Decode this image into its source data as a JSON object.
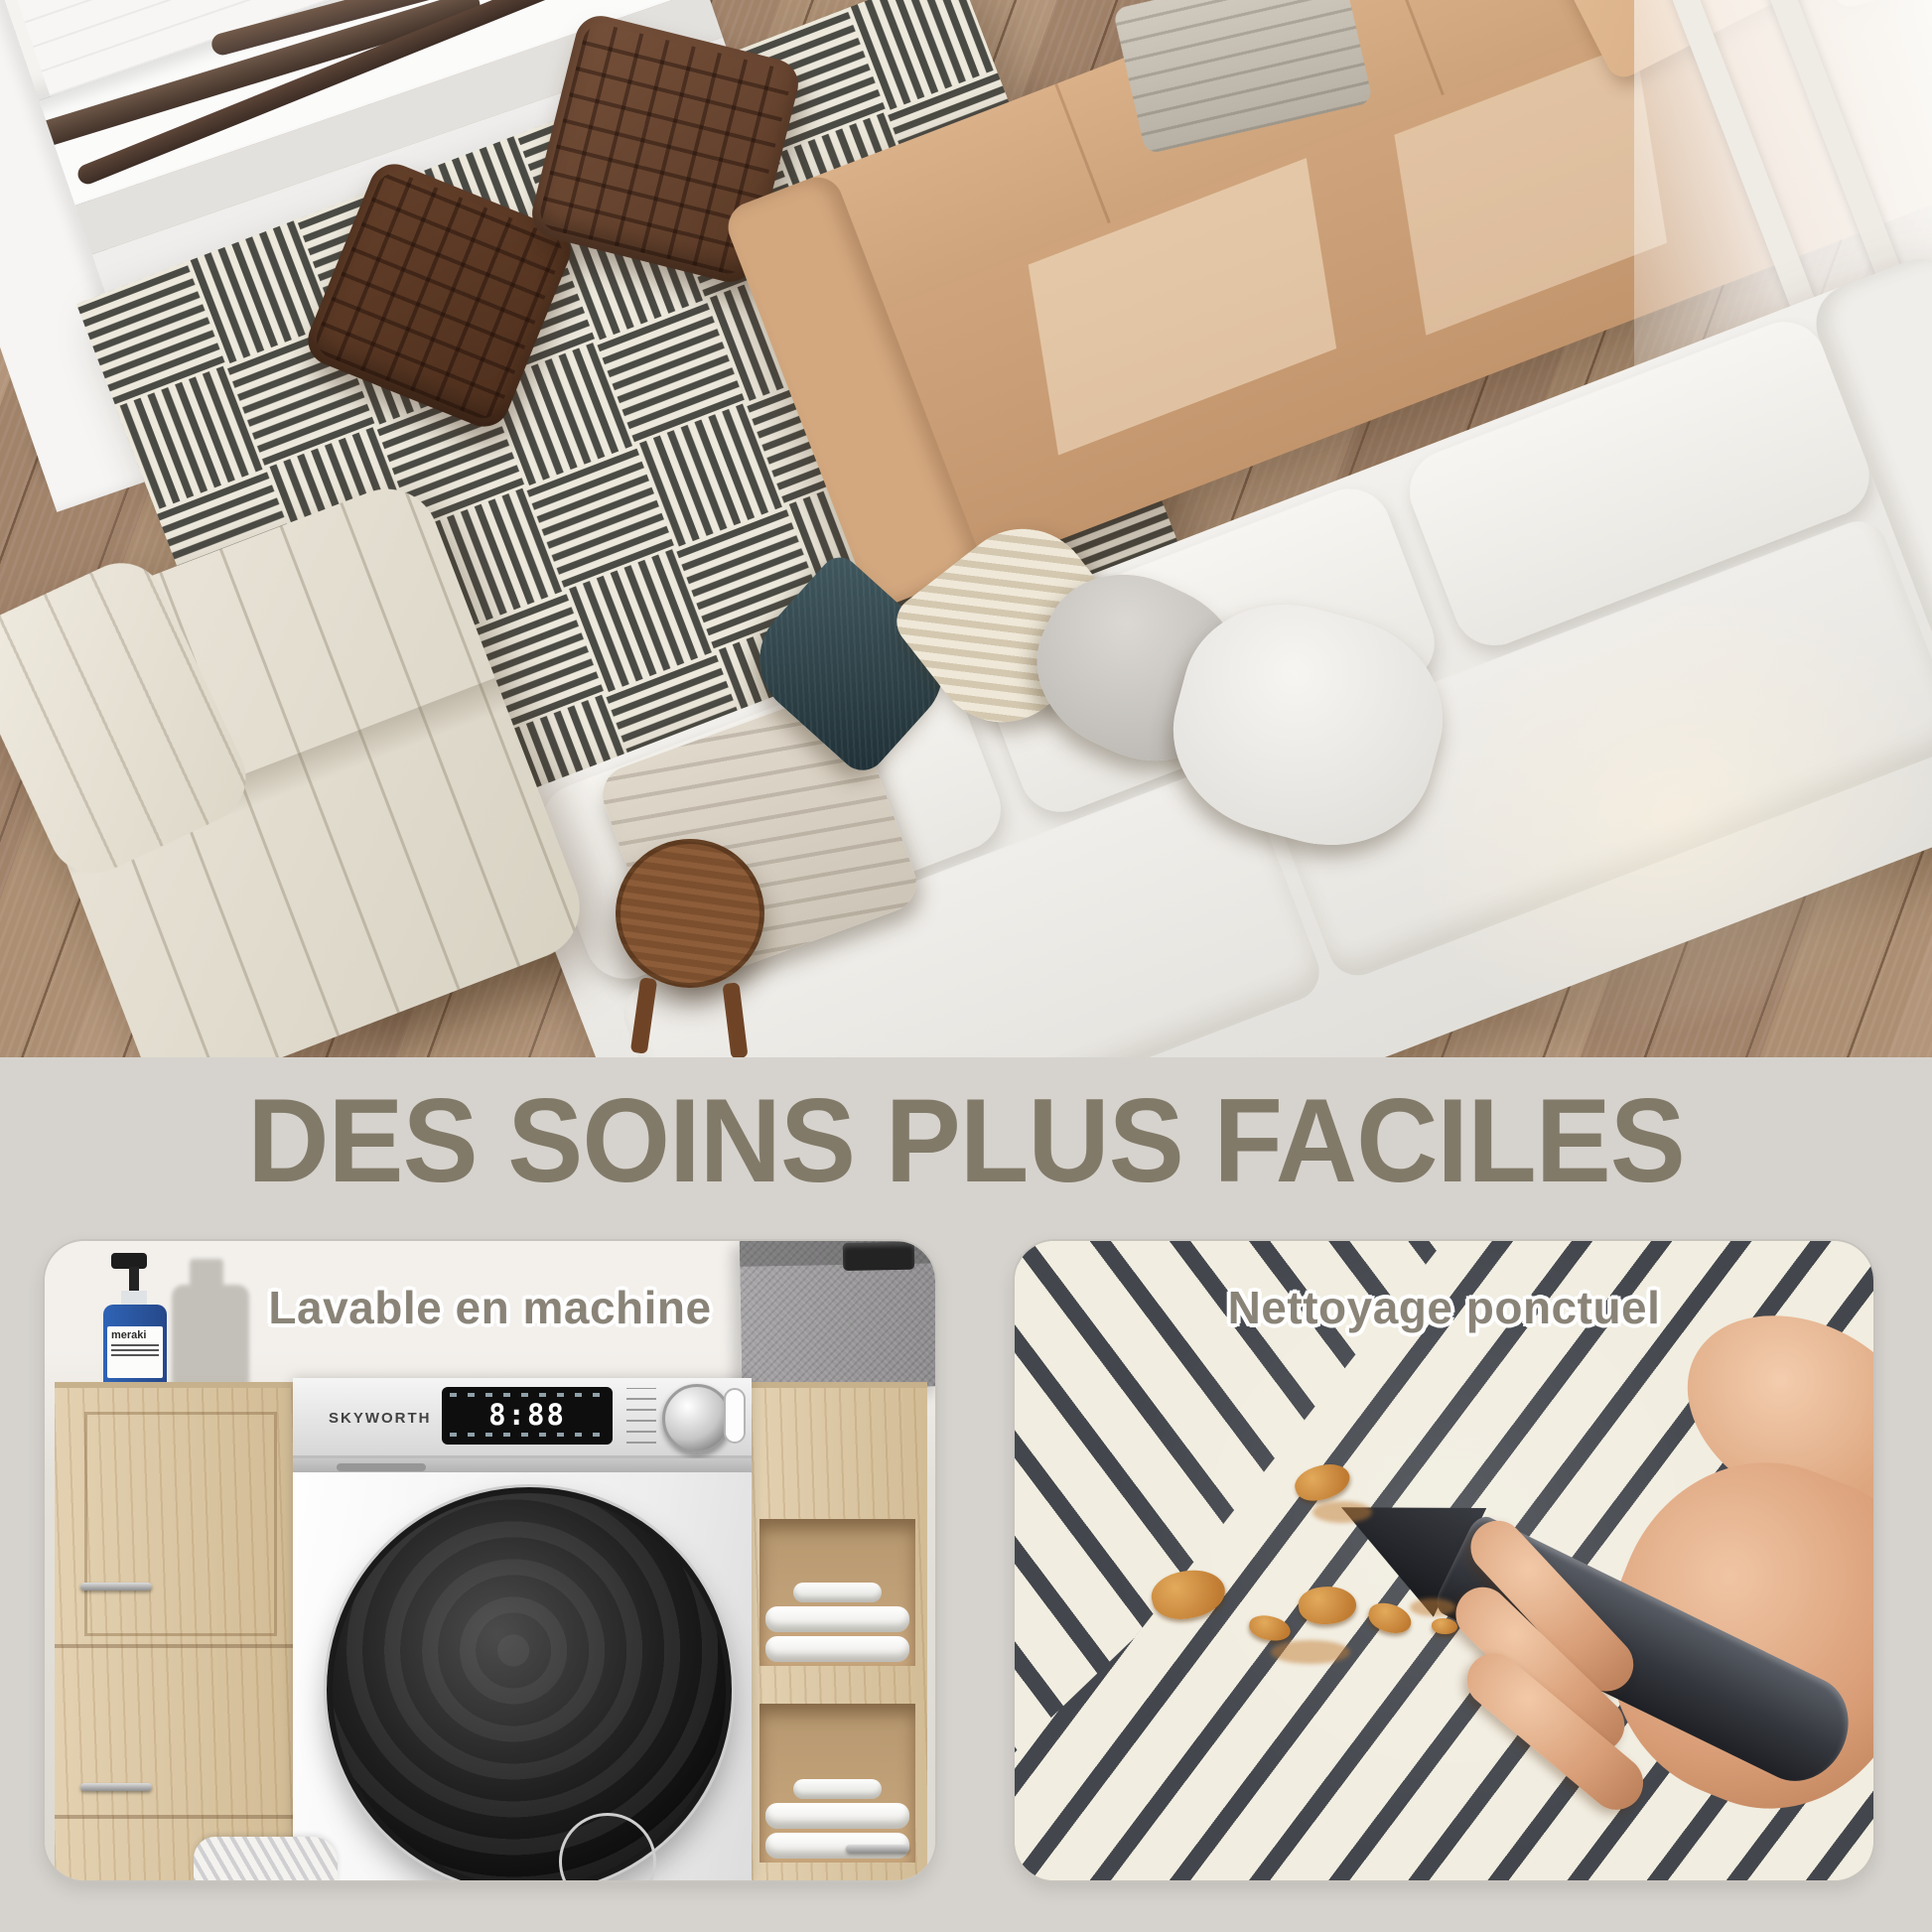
{
  "heading": {
    "text": "DES SOINS PLUS FACILES",
    "color": "#827a69"
  },
  "section": {
    "background": "#d6d3ce"
  },
  "left_panel": {
    "caption": "Lavable en machine",
    "machine_brand": "SKYWORTH",
    "machine_display_time": "8:88",
    "bottle_label": "meraki"
  },
  "right_panel": {
    "caption": "Nettoyage ponctuel"
  },
  "palette": {
    "caption_color": "#8a8478",
    "rug_dark": "#43474d",
    "rug_cream": "#f1ede0",
    "floor_wood": "#ab8e72",
    "sofa_tan": "#cba27b",
    "sofa_white": "#eceae6",
    "pouf_brown": "#5f3d29",
    "accent_blue_bottle": "#2f64b6",
    "teal_pillow": "#2f444b"
  }
}
